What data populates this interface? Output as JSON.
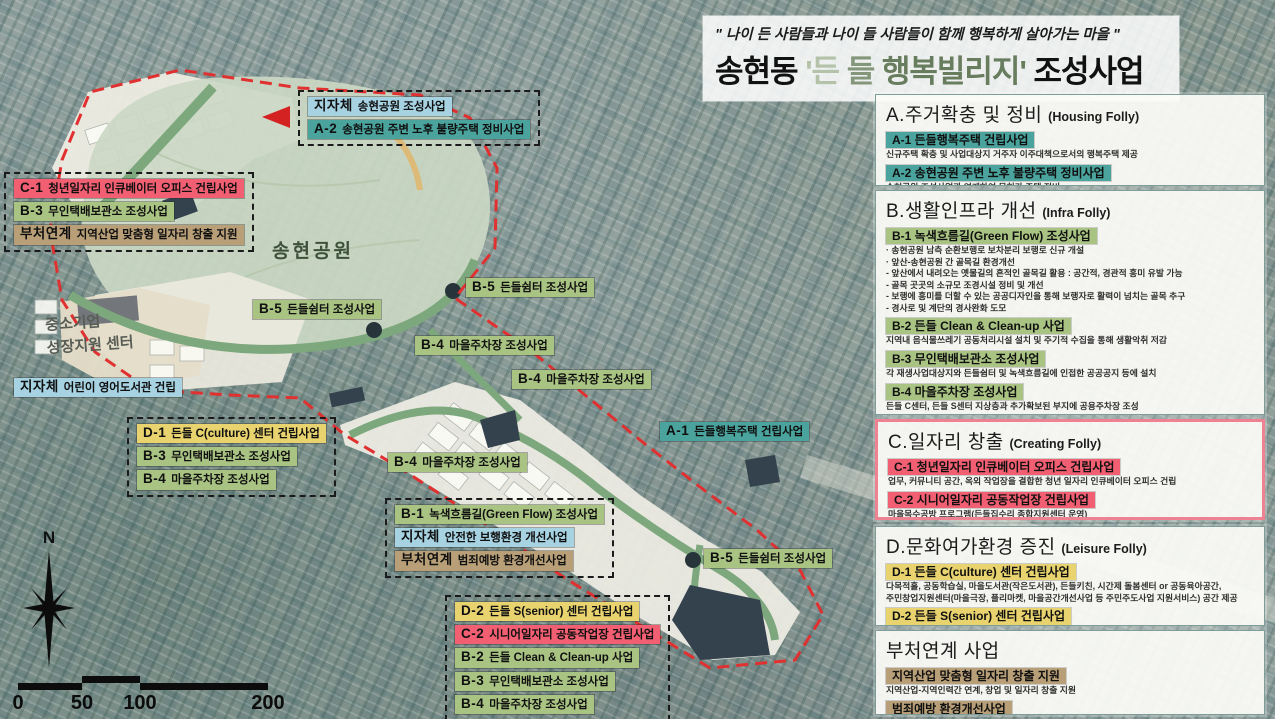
{
  "palette": {
    "teal": "#4aa39c",
    "green": "#a9c383",
    "pink": "#f25f72",
    "yellow": "#e8d36e",
    "tan": "#b89f78",
    "blue": "#a6d2e2",
    "boundary_red": "#e03030",
    "park_green": "#cbd8c4"
  },
  "title": {
    "quote": "\" 나이 든 사람들과 나이 들 사람들이 함께 행복하게 살아가는 마을 \"",
    "main1": "송현동 ",
    "main2": "'든",
    "main3": " 들",
    "main4": " 행복빌리지'",
    "main5": " 조성사업"
  },
  "legend": {
    "sections": [
      {
        "accent": "teal",
        "heading": "A.주거확충 및 정비",
        "heading_en": "(Housing Folly)",
        "items": [
          {
            "label": "A-1 든들행복주택 건립사업",
            "desc": "신규주택 확충 및 사업대상지 거주자 이주대책으로서의 행복주택 제공"
          },
          {
            "label": "A-2 송현공원 주변 노후 불량주택 정비사업",
            "desc": "송현공원 조성사업과 연계하여 무허가 주택 정비"
          }
        ]
      },
      {
        "accent": "green",
        "heading": "B.생활인프라 개선",
        "heading_en": "(Infra Folly)",
        "items": [
          {
            "label": "B-1 녹색흐름길(Green Flow) 조성사업",
            "desc": "· 송현공원 남측 순환보행로 보차분리 보행로 신규 개설\n· 앞산-송현공원 간 골목길 환경개선\n - 앞산에서 내려오는 옛물길의 흔적인 골목길 활용 : 공간적, 경관적 흥미 유발 가능\n - 골목 곳곳의 소규모 조경시설 정비 및 개선\n - 보행에 흥미를 더할 수 있는 공공디자인을 통해 보행자로 활력이 넘치는 골목 추구\n - 경사로 및 계단의 경사완화 도모"
          },
          {
            "label": "B-2 든들 Clean & Clean-up 사업",
            "desc": "지역내 음식물쓰레기 공동처리시설 설치 및 주기적 수집을 통해 생활악취 저감"
          },
          {
            "label": "B-3 무인택배보관소 조성사업",
            "desc": "각 재생사업대상지와 든들쉼터 및 녹색흐름길에 인접한 공공공지 등에 설치"
          },
          {
            "label": "B-4 마을주차장 조성사업",
            "desc": "든들 C센터, 든들 S센터 지상층과 추가확보된 부지에 공용주차장 조성"
          },
          {
            "label": "B-5 든들쉼터 조성사업",
            "desc": "송현공원 인근 보행로와 연계하여 쌈지공간을 활용한 쉼터 조성"
          }
        ]
      },
      {
        "accent": "pink",
        "heading": "C.일자리 창출",
        "heading_en": "(Creating Folly)",
        "items": [
          {
            "label": "C-1 청년일자리 인큐베이터 오피스 건립사업",
            "desc": "업무, 커뮤니티 공간, 옥외 작업장을 결합한 청년 일자리 인큐베이터 오피스 건립"
          },
          {
            "label": "C-2 시니어일자리 공동작업장 건립사업",
            "desc": "마을목수공방 프로그램(든들집수리 종합지원센터 운영)\n시니어 일자리 지원센터 운영"
          }
        ]
      },
      {
        "accent": "yellow",
        "heading": "D.문화여가환경 증진",
        "heading_en": "(Leisure Folly)",
        "items": [
          {
            "label": "D-1 든들 C(culture) 센터 건립사업",
            "desc": "다목적홀, 공동학습실, 마을도서관(작은도서관), 든들키친, 시간제 돌봄센터 or 공동육아공간,\n주민창업지원센터(마을극장, 플리마켓, 마을공간개선사업 등 주민주도사업 지원서비스) 공간 제공"
          },
          {
            "label": "D-2 든들 S(senior) 센터 건립사업",
            "desc": "프로그램별 운영실 및 다목적실, 시니어전용 피트니스센터, 치매 및 노인건강관리센터,\n실버 카페 공간 제공"
          }
        ]
      },
      {
        "accent": "tan",
        "heading": "부처연계 사업",
        "heading_en": "",
        "items": [
          {
            "label": "지역산업 맞춤형 일자리 창출 지원",
            "desc": "지역산업-지역인력간 연계, 창업 및 일자리 창출 지원"
          },
          {
            "label": "범죄예방 환경개선사업",
            "desc": "범죄취약지역 발굴 및 개선 등을 통해 골목길 환경 개선"
          }
        ]
      }
    ]
  },
  "map": {
    "park_label": "송현공원",
    "center_building_label": "중소기업\n성장지원 센터",
    "box_top": [
      {
        "prefix": "지자체",
        "text": "송현공원 조성사업",
        "color": "blue"
      },
      {
        "prefix": "A-2",
        "text": "송현공원 주변 노후 불량주택 정비사업",
        "color": "teal"
      }
    ],
    "box_left": [
      {
        "prefix": "C-1",
        "text": "청년일자리 인큐베이터 오피스 건립사업",
        "color": "pink"
      },
      {
        "prefix": "B-3",
        "text": "무인택배보관소 조성사업",
        "color": "green"
      },
      {
        "prefix": "부처연계",
        "text": "지역산업 맞춤형 일자리 창출 지원",
        "color": "tan"
      }
    ],
    "box_mid": [
      {
        "prefix": "D-1",
        "text": "든들 C(culture) 센터 건립사업",
        "color": "yellow"
      },
      {
        "prefix": "B-3",
        "text": "무인택배보관소 조성사업",
        "color": "green"
      },
      {
        "prefix": "B-4",
        "text": "마을주차장 조성사업",
        "color": "green"
      }
    ],
    "box_b1": [
      {
        "prefix": "B-1",
        "text": "녹색흐름길(Green Flow) 조성사업",
        "color": "green"
      },
      {
        "prefix": "지자체",
        "text": "안전한 보행환경 개선사업",
        "color": "blue"
      },
      {
        "prefix": "부처연계",
        "text": "범죄예방 환경개선사업",
        "color": "tan"
      }
    ],
    "box_bottom": [
      {
        "prefix": "D-2",
        "text": "든들 S(senior) 센터 건립사업",
        "color": "yellow"
      },
      {
        "prefix": "C-2",
        "text": "시니어일자리 공동작업장 건립사업",
        "color": "pink"
      },
      {
        "prefix": "B-2",
        "text": "든들 Clean & Clean-up 사업",
        "color": "green"
      },
      {
        "prefix": "B-3",
        "text": "무인택배보관소 조성사업",
        "color": "green"
      },
      {
        "prefix": "B-4",
        "text": "마을주차장 조성사업",
        "color": "green"
      }
    ],
    "chips": [
      {
        "prefix": "B-5",
        "text": "든들쉼터 조성사업",
        "color": "green"
      },
      {
        "prefix": "B-5",
        "text": "든들쉼터 조성사업",
        "color": "green"
      },
      {
        "prefix": "B-4",
        "text": "마을주차장 조성사업",
        "color": "green"
      },
      {
        "prefix": "B-4",
        "text": "마을주차장 조성사업",
        "color": "green"
      },
      {
        "prefix": "B-4",
        "text": "마을주차장 조성사업",
        "color": "green"
      },
      {
        "prefix": "A-1",
        "text": "든들행복주택 건립사업",
        "color": "teal"
      },
      {
        "prefix": "B-5",
        "text": "든들쉼터 조성사업",
        "color": "green"
      },
      {
        "prefix": "지자체",
        "text": "어린이 영어도서관 건립",
        "color": "blue"
      }
    ],
    "compass_label": "N",
    "scale_ticks": [
      "0",
      "50",
      "100",
      "200"
    ]
  }
}
